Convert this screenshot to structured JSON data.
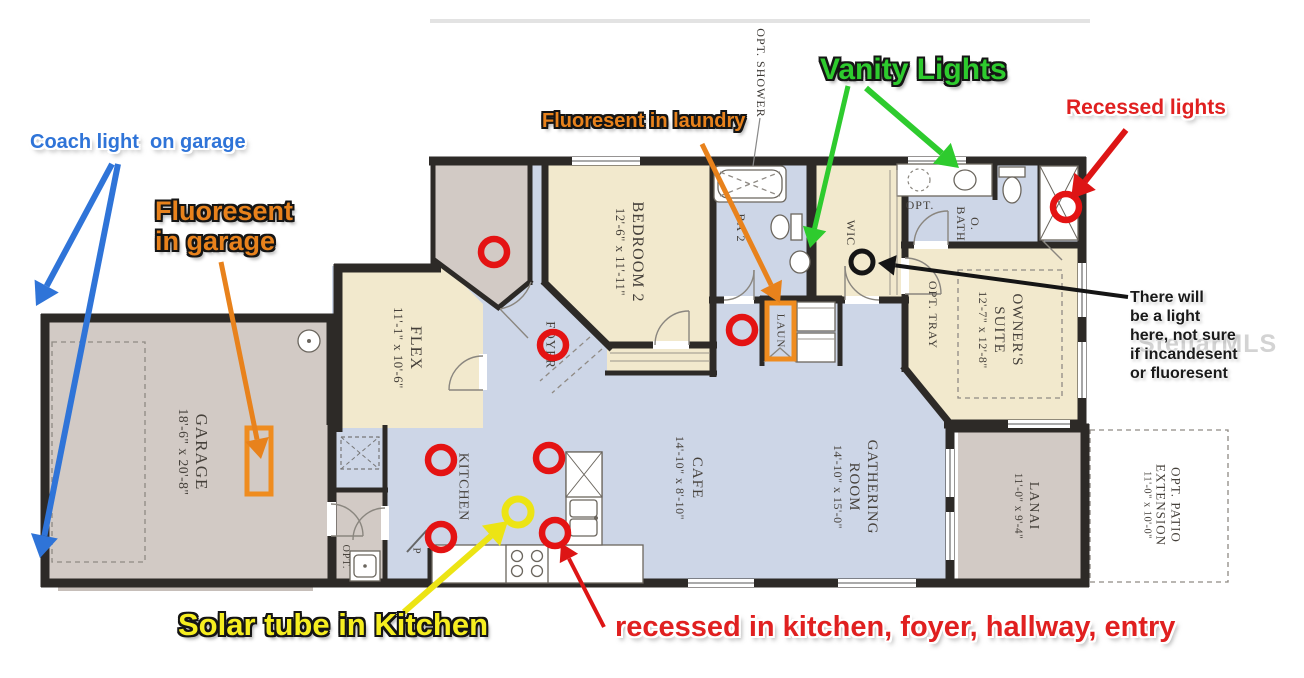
{
  "annotations": {
    "coach_light": {
      "text": "Coach light  on garage",
      "color": "#2f74d8"
    },
    "fluorescent_garage": {
      "text": "Fluoresent\nin garage",
      "color": "#e8821c"
    },
    "fluorescent_laundry": {
      "text": "Fluoresent in laundry",
      "color": "#e8821c"
    },
    "vanity_lights": {
      "text": "Vanity Lights",
      "color": "#2ecb2e"
    },
    "recessed_lights": {
      "text": "Recessed lights",
      "color": "#e02020"
    },
    "light_note": {
      "text": "There will\nbe a light\nhere, not sure\nif incandesent\nor fluoresent",
      "color": "#1a1a1a"
    },
    "solar_tube": {
      "text": "Solar tube in Kitchen",
      "color": "#f6ee20"
    },
    "recessed_note": {
      "text": "recessed in kitchen, foyer, hallway, entry",
      "color": "#e02020"
    }
  },
  "watermark": "StellarMLS",
  "rooms": {
    "garage": {
      "name": "GARAGE",
      "dims": "18'-6\" x 20'-8\""
    },
    "flex": {
      "name": "FLEX",
      "dims": "11'-1\" x 10'-6\""
    },
    "bedroom2": {
      "name": "BEDROOM 2",
      "dims": "12'-6\" x 11'-11\""
    },
    "foyer": {
      "name": "FOYER"
    },
    "ba2": {
      "name": "BA 2"
    },
    "laun": {
      "name": "LAUN"
    },
    "wic": {
      "name": "WIC"
    },
    "opt_shower": {
      "name": "OPT. SHOWER"
    },
    "opt_bath": {
      "name": "OPT."
    },
    "o_bath": {
      "name": "O.\nBATH"
    },
    "owners_suite": {
      "name": "OWNER'S\nSUITE",
      "dims": "12'-7\" x 12'-8\""
    },
    "opt_tray": {
      "name": "OPT. TRAY"
    },
    "kitchen": {
      "name": "KITCHEN"
    },
    "pantry": {
      "name": "P"
    },
    "opt_utility": {
      "name": "OPT."
    },
    "cafe": {
      "name": "CAFE",
      "dims": "14'-10\" x 8'-10\""
    },
    "gathering": {
      "name": "GATHERING\nROOM",
      "dims": "14'-10\" x 15'-0\""
    },
    "lanai": {
      "name": "LANAI",
      "dims": "11'-0\" x 9'-4\""
    },
    "patio": {
      "name": "OPT. PATIO\nEXTENSION",
      "dims": "11'-0\" x 10'-0\""
    }
  },
  "markers": {
    "recessed_color": "#e41313",
    "solar_color": "#ece414",
    "note_color": "#151515",
    "fluorescent_color": "#ef8c1f",
    "recessed_circles": [
      [
        494,
        252
      ],
      [
        553,
        345
      ],
      [
        742,
        330
      ],
      [
        1066,
        207
      ],
      [
        441,
        460
      ],
      [
        549,
        458
      ],
      [
        441,
        537
      ],
      [
        555,
        533
      ]
    ],
    "solar_circle": [
      518,
      512
    ],
    "note_circle": [
      862,
      262
    ],
    "fluorescent_rects": [
      [
        247,
        428,
        24,
        66
      ],
      [
        767,
        303,
        27,
        56
      ]
    ]
  },
  "arrows": [
    {
      "from": [
        112,
        164
      ],
      "to": [
        36,
        306
      ],
      "color": "#2f74d8",
      "w": 6
    },
    {
      "from": [
        118,
        164
      ],
      "to": [
        40,
        558
      ],
      "color": "#2f74d8",
      "w": 6
    },
    {
      "from": [
        221,
        262
      ],
      "to": [
        261,
        459
      ],
      "color": "#e8821c",
      "w": 5
    },
    {
      "from": [
        702,
        144
      ],
      "to": [
        780,
        303
      ],
      "color": "#e8821c",
      "w": 5
    },
    {
      "from": [
        848,
        86
      ],
      "to": [
        810,
        248
      ],
      "color": "#2ecb2e",
      "w": 5
    },
    {
      "from": [
        866,
        88
      ],
      "to": [
        959,
        168
      ],
      "color": "#2ecb2e",
      "w": 6
    },
    {
      "from": [
        1126,
        130
      ],
      "to": [
        1071,
        199
      ],
      "color": "#dd1515",
      "w": 6
    },
    {
      "from": [
        1128,
        297
      ],
      "to": [
        878,
        263
      ],
      "color": "#151515",
      "w": 4
    },
    {
      "from": [
        404,
        612
      ],
      "to": [
        508,
        521
      ],
      "color": "#ece414",
      "w": 6
    },
    {
      "from": [
        604,
        627
      ],
      "to": [
        561,
        543
      ],
      "color": "#dd1515",
      "w": 4
    }
  ]
}
